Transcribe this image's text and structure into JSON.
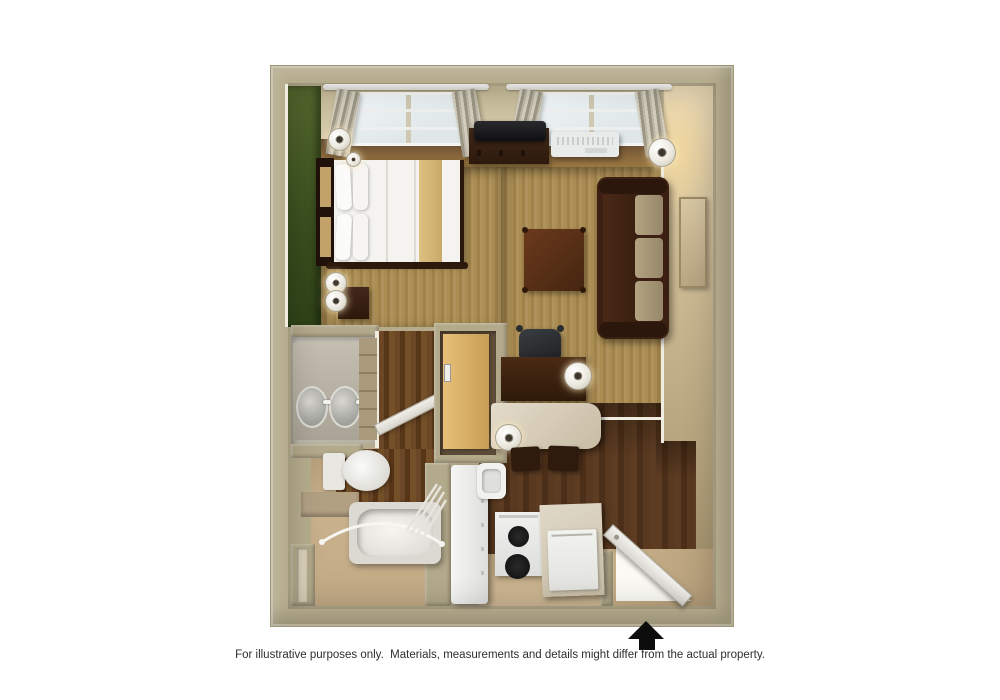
{
  "disclaimer": "For illustrative purposes only.  Materials, measurements and details might differ from the actual property.",
  "entrance": {
    "indicator": "up-arrow",
    "meaning": "entrance location"
  },
  "floorplan": {
    "style": "3D top-down studio suite rendering",
    "rooms": {
      "living_sleeping": "Living and sleeping area with queen bed and sofa",
      "vanity": "Vanity area with double sinks",
      "bathroom": "Bathroom with toilet and tub with shower rod",
      "closet": "Closet with sliding wood door",
      "work_dining": "Desk and breakfast counter area",
      "kitchen": "Kitchen with refrigerator, stove and cabinets",
      "entry": "Entry with open door"
    },
    "furniture": {
      "bed": "Queen bed with white bedding and tan runner",
      "headboard": "Dark wood headboard",
      "nightstand": "Dark wood nightstand with lamps",
      "tv": "Flat-screen TV on media console",
      "tv_console": "Dark wood media console",
      "ac_unit": "Wall air-conditioning unit",
      "sofa": "Brown sofa with tan cushions",
      "ottoman": "Square dark wood table",
      "wall_art": "Framed wall art",
      "floor_lamp": "Floor lamp",
      "desk": "Dark wood desk",
      "office_chair": "Black office chair",
      "counter": "Cream breakfast counter with two stools",
      "vanity_sinks": "Two oval sinks",
      "toilet": "Toilet",
      "bathtub": "Bathtub with curved shower rod and curtain",
      "refrigerator": "White refrigerator",
      "stove": "Two-burner stove",
      "kitchen_cabinet": "Kitchen cabinet with drawer",
      "entry_door": "Open entry door",
      "windows": "Two curtained windows",
      "green_accent_wall": "Green accent wall"
    },
    "colors": {
      "outer_wall": "#b6ac8d",
      "accent_wall_green": "#3b501f",
      "carpet": "#a78a50",
      "wood_floor": "#53361f",
      "interior_wall_beige": "#cdbb94",
      "bath_floor": "#c6ae8b",
      "white_fixture": "#f0efec",
      "sofa_brown": "#3a1f12",
      "cushion_tan": "#a99877",
      "arrow_black": "#0d0d0d"
    }
  }
}
